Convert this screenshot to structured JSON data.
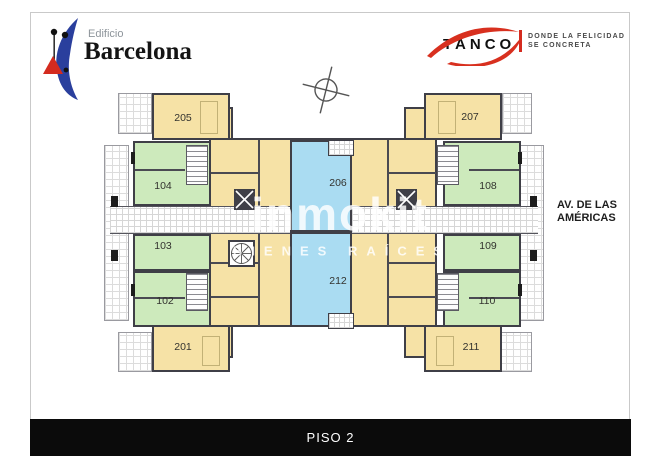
{
  "brand": {
    "name_small": "Edificio",
    "name_big": "Barcelona",
    "crescent_color": "#2a3f9d",
    "accent_red": "#d42b1f"
  },
  "developer": {
    "name": "TANCO",
    "tagline_line1": "DONDE LA FELICIDAD",
    "tagline_line2": "SE CONCRETA",
    "accent": "#d42b1f"
  },
  "street_label": {
    "line1": "AV. DE LAS",
    "line2": "AMÉRICAS"
  },
  "floor_bar": {
    "label": "PISO 2",
    "bg": "#0b0b0b"
  },
  "watermark": {
    "title": "inmokit",
    "subtitle": "BIENES RAÍCES"
  },
  "plan_colors": {
    "apartment_yellow": "#f6e2a6",
    "apartment_green": "#cdeabc",
    "apartment_blue": "#aadcf2",
    "wall": "#3f3f47"
  },
  "units": [
    {
      "id": "205",
      "color": "yellow"
    },
    {
      "id": "207",
      "color": "yellow"
    },
    {
      "id": "104",
      "color": "green"
    },
    {
      "id": "108",
      "color": "green"
    },
    {
      "id": "103",
      "color": "green"
    },
    {
      "id": "109",
      "color": "green"
    },
    {
      "id": "102",
      "color": "green"
    },
    {
      "id": "110",
      "color": "green"
    },
    {
      "id": "201",
      "color": "yellow"
    },
    {
      "id": "211",
      "color": "yellow"
    },
    {
      "id": "206",
      "color": "blue"
    },
    {
      "id": "212",
      "color": "blue"
    }
  ]
}
